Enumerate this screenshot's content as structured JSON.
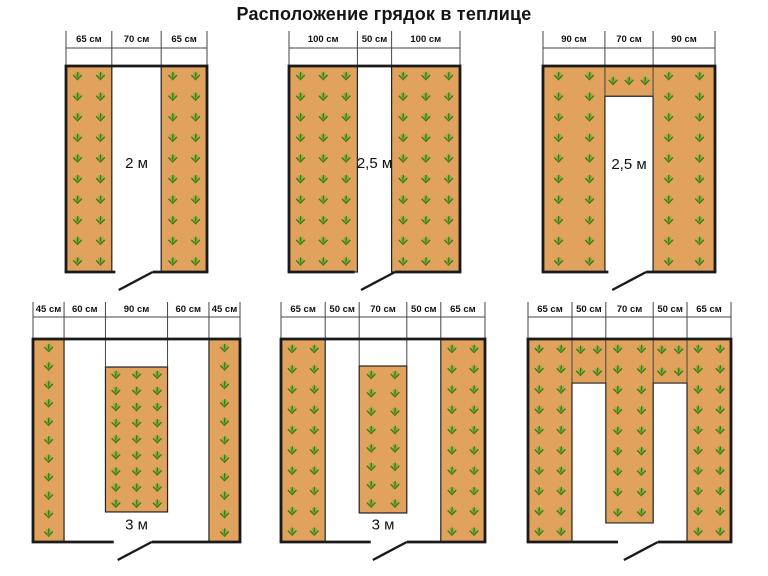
{
  "title": "Расположение грядок в теплице",
  "colors": {
    "bed_fill": "#e1a25d",
    "bed_stroke": "#222222",
    "wall": "#1a1a1a",
    "dim_line": "#444444",
    "text": "#111111",
    "plant_dark": "#3e761c",
    "plant_light": "#7fb135"
  },
  "diagrams": [
    {
      "name": "greenhouse-2m-two-side-beds",
      "cell": {
        "x": 0,
        "y": 25,
        "w": 256,
        "h": 270
      },
      "box": {
        "left": 66,
        "top": 41,
        "width": 141,
        "height": 206
      },
      "dim": {
        "tick_top": 6,
        "line_y": 23,
        "text_y": 17
      },
      "total_cm": 200,
      "measurements": [
        {
          "label": "65 см",
          "cm": 65
        },
        {
          "label": "70 см",
          "cm": 70
        },
        {
          "label": "65 см",
          "cm": 65
        }
      ],
      "aisle_label": {
        "text": "2 м",
        "x_cm": 100,
        "y_frac": 0.47
      },
      "beds": [
        {
          "shape": "rect",
          "x0": 0,
          "x1": 65,
          "y0": 0,
          "y1": 1
        },
        {
          "shape": "rect",
          "x0": 135,
          "x1": 200,
          "y0": 0,
          "y1": 1
        }
      ],
      "plants": [
        {
          "x0": 0,
          "x1": 65,
          "y0": 0,
          "y1": 1,
          "cols": 2,
          "rows": 10
        },
        {
          "x0": 135,
          "x1": 200,
          "y0": 0,
          "y1": 1,
          "cols": 2,
          "rows": 10
        }
      ],
      "door": {
        "x0_cm": 70,
        "x1_cm": 123
      },
      "deep_ticks": []
    },
    {
      "name": "greenhouse-2-5m-two-side-beds",
      "cell": {
        "x": 256,
        "y": 25,
        "w": 256,
        "h": 270
      },
      "box": {
        "left": 33,
        "top": 41,
        "width": 171,
        "height": 206
      },
      "dim": {
        "tick_top": 6,
        "line_y": 23,
        "text_y": 17
      },
      "total_cm": 250,
      "measurements": [
        {
          "label": "100 см",
          "cm": 100
        },
        {
          "label": "50 см",
          "cm": 50
        },
        {
          "label": "100 см",
          "cm": 100
        }
      ],
      "aisle_label": {
        "text": "2,5 м",
        "x_cm": 125,
        "y_frac": 0.47
      },
      "beds": [
        {
          "shape": "rect",
          "x0": 0,
          "x1": 100,
          "y0": 0,
          "y1": 1
        },
        {
          "shape": "rect",
          "x0": 150,
          "x1": 250,
          "y0": 0,
          "y1": 1
        }
      ],
      "plants": [
        {
          "x0": 0,
          "x1": 100,
          "y0": 0,
          "y1": 1,
          "cols": 3,
          "rows": 10
        },
        {
          "x0": 150,
          "x1": 250,
          "y0": 0,
          "y1": 1,
          "cols": 3,
          "rows": 10
        }
      ],
      "door": {
        "x0_cm": 96,
        "x1_cm": 155
      },
      "deep_ticks": []
    },
    {
      "name": "greenhouse-2-5m-u-shaped-bed",
      "cell": {
        "x": 512,
        "y": 25,
        "w": 256,
        "h": 270
      },
      "box": {
        "left": 31,
        "top": 41,
        "width": 172,
        "height": 206
      },
      "dim": {
        "tick_top": 6,
        "line_y": 23,
        "text_y": 17
      },
      "total_cm": 250,
      "measurements": [
        {
          "label": "90 см",
          "cm": 90
        },
        {
          "label": "70 см",
          "cm": 70
        },
        {
          "label": "90 см",
          "cm": 90
        }
      ],
      "aisle_label": {
        "text": "2,5 м",
        "x_cm": 125,
        "y_frac": 0.475
      },
      "beds": [
        {
          "shape": "poly",
          "points": [
            [
              0,
              0
            ],
            [
              250,
              0
            ],
            [
              250,
              1
            ],
            [
              160,
              1
            ],
            [
              160,
              0.147
            ],
            [
              90,
              0.147
            ],
            [
              90,
              1
            ],
            [
              0,
              1
            ]
          ]
        }
      ],
      "plants": [
        {
          "x0": 0,
          "x1": 90,
          "y0": 0,
          "y1": 1,
          "cols": 2,
          "rows": 10
        },
        {
          "x0": 160,
          "x1": 250,
          "y0": 0,
          "y1": 1,
          "cols": 2,
          "rows": 10
        },
        {
          "x0": 90,
          "x1": 160,
          "y0": 0,
          "y1": 0.147,
          "cols": 3,
          "rows": 1
        }
      ],
      "door": {
        "x0_cm": 95,
        "x1_cm": 150
      },
      "deep_ticks": [
        {
          "cm": 90,
          "to_frac": 0.147
        },
        {
          "cm": 160,
          "to_frac": 0.147
        }
      ]
    },
    {
      "name": "greenhouse-3m-three-beds-narrow-sides",
      "cell": {
        "x": 0,
        "y": 295,
        "w": 256,
        "h": 281
      },
      "box": {
        "left": 33,
        "top": 44,
        "width": 207,
        "height": 203
      },
      "dim": {
        "tick_top": 7,
        "line_y": 22,
        "text_y": 17
      },
      "total_cm": 300,
      "measurements": [
        {
          "label": "45 см",
          "cm": 45
        },
        {
          "label": "60 см",
          "cm": 60
        },
        {
          "label": "90 см",
          "cm": 90
        },
        {
          "label": "60 см",
          "cm": 60
        },
        {
          "label": "45 см",
          "cm": 45
        }
      ],
      "aisle_label": {
        "text": "3 м",
        "x_cm": 150,
        "y_frac": 0.915
      },
      "beds": [
        {
          "shape": "rect",
          "x0": 0,
          "x1": 45,
          "y0": 0,
          "y1": 1
        },
        {
          "shape": "rect",
          "x0": 255,
          "x1": 300,
          "y0": 0,
          "y1": 1
        },
        {
          "shape": "rect",
          "x0": 105,
          "x1": 195,
          "y0": 0.138,
          "y1": 0.852
        }
      ],
      "plants": [
        {
          "x0": 0,
          "x1": 45,
          "y0": 0,
          "y1": 1,
          "cols": 1,
          "rows": 11
        },
        {
          "x0": 255,
          "x1": 300,
          "y0": 0,
          "y1": 1,
          "cols": 1,
          "rows": 11
        },
        {
          "x0": 105,
          "x1": 195,
          "y0": 0.138,
          "y1": 0.852,
          "cols": 3,
          "rows": 9
        }
      ],
      "door": {
        "x0_cm": 117,
        "x1_cm": 172
      },
      "deep_ticks": [
        {
          "cm": 105,
          "to_frac": 0.138
        },
        {
          "cm": 195,
          "to_frac": 0.138
        }
      ]
    },
    {
      "name": "greenhouse-3m-three-beds-wide-sides",
      "cell": {
        "x": 256,
        "y": 295,
        "w": 256,
        "h": 281
      },
      "box": {
        "left": 25,
        "top": 44,
        "width": 204,
        "height": 203
      },
      "dim": {
        "tick_top": 7,
        "line_y": 22,
        "text_y": 17
      },
      "total_cm": 300,
      "measurements": [
        {
          "label": "65 см",
          "cm": 65
        },
        {
          "label": "50 см",
          "cm": 50
        },
        {
          "label": "70 см",
          "cm": 70
        },
        {
          "label": "50 см",
          "cm": 50
        },
        {
          "label": "65 см",
          "cm": 65
        }
      ],
      "aisle_label": {
        "text": "3 м",
        "x_cm": 150,
        "y_frac": 0.915
      },
      "beds": [
        {
          "shape": "rect",
          "x0": 0,
          "x1": 65,
          "y0": 0,
          "y1": 1
        },
        {
          "shape": "rect",
          "x0": 235,
          "x1": 300,
          "y0": 0,
          "y1": 1
        },
        {
          "shape": "rect",
          "x0": 115,
          "x1": 185,
          "y0": 0.133,
          "y1": 0.857
        }
      ],
      "plants": [
        {
          "x0": 0,
          "x1": 65,
          "y0": 0,
          "y1": 1,
          "cols": 2,
          "rows": 10
        },
        {
          "x0": 235,
          "x1": 300,
          "y0": 0,
          "y1": 1,
          "cols": 2,
          "rows": 10
        },
        {
          "x0": 115,
          "x1": 185,
          "y0": 0.133,
          "y1": 0.857,
          "cols": 2,
          "rows": 8
        }
      ],
      "door": {
        "x0_cm": 132,
        "x1_cm": 185
      },
      "deep_ticks": [
        {
          "cm": 115,
          "to_frac": 0.133
        },
        {
          "cm": 185,
          "to_frac": 0.133
        }
      ]
    },
    {
      "name": "greenhouse-3m-comb-shaped-bed",
      "cell": {
        "x": 512,
        "y": 295,
        "w": 256,
        "h": 281
      },
      "box": {
        "left": 16,
        "top": 44,
        "width": 203,
        "height": 203
      },
      "dim": {
        "tick_top": 7,
        "line_y": 22,
        "text_y": 17
      },
      "total_cm": 300,
      "measurements": [
        {
          "label": "65 см",
          "cm": 65
        },
        {
          "label": "50 см",
          "cm": 50
        },
        {
          "label": "70 см",
          "cm": 70
        },
        {
          "label": "50 см",
          "cm": 50
        },
        {
          "label": "65 см",
          "cm": 65
        }
      ],
      "aisle_label": null,
      "beds": [
        {
          "shape": "poly",
          "points": [
            [
              0,
              0
            ],
            [
              300,
              0
            ],
            [
              300,
              1
            ],
            [
              235,
              1
            ],
            [
              235,
              0.217
            ],
            [
              185,
              0.217
            ],
            [
              185,
              0.906
            ],
            [
              115,
              0.906
            ],
            [
              115,
              0.217
            ],
            [
              65,
              0.217
            ],
            [
              65,
              1
            ],
            [
              0,
              1
            ]
          ]
        }
      ],
      "plants": [
        {
          "x0": 0,
          "x1": 65,
          "y0": 0,
          "y1": 1,
          "cols": 2,
          "rows": 10
        },
        {
          "x0": 235,
          "x1": 300,
          "y0": 0,
          "y1": 1,
          "cols": 2,
          "rows": 10
        },
        {
          "x0": 115,
          "x1": 185,
          "y0": 0,
          "y1": 0.906,
          "cols": 2,
          "rows": 9
        },
        {
          "x0": 65,
          "x1": 115,
          "y0": 0,
          "y1": 0.217,
          "cols": 2,
          "rows": 2
        },
        {
          "x0": 185,
          "x1": 235,
          "y0": 0,
          "y1": 0.217,
          "cols": 2,
          "rows": 2
        }
      ],
      "door": {
        "x0_cm": 133,
        "x1_cm": 192
      },
      "deep_ticks": [
        {
          "cm": 65,
          "to_frac": 0.217
        },
        {
          "cm": 115,
          "to_frac": 0.217
        },
        {
          "cm": 185,
          "to_frac": 0.217
        },
        {
          "cm": 235,
          "to_frac": 0.217
        }
      ]
    }
  ]
}
